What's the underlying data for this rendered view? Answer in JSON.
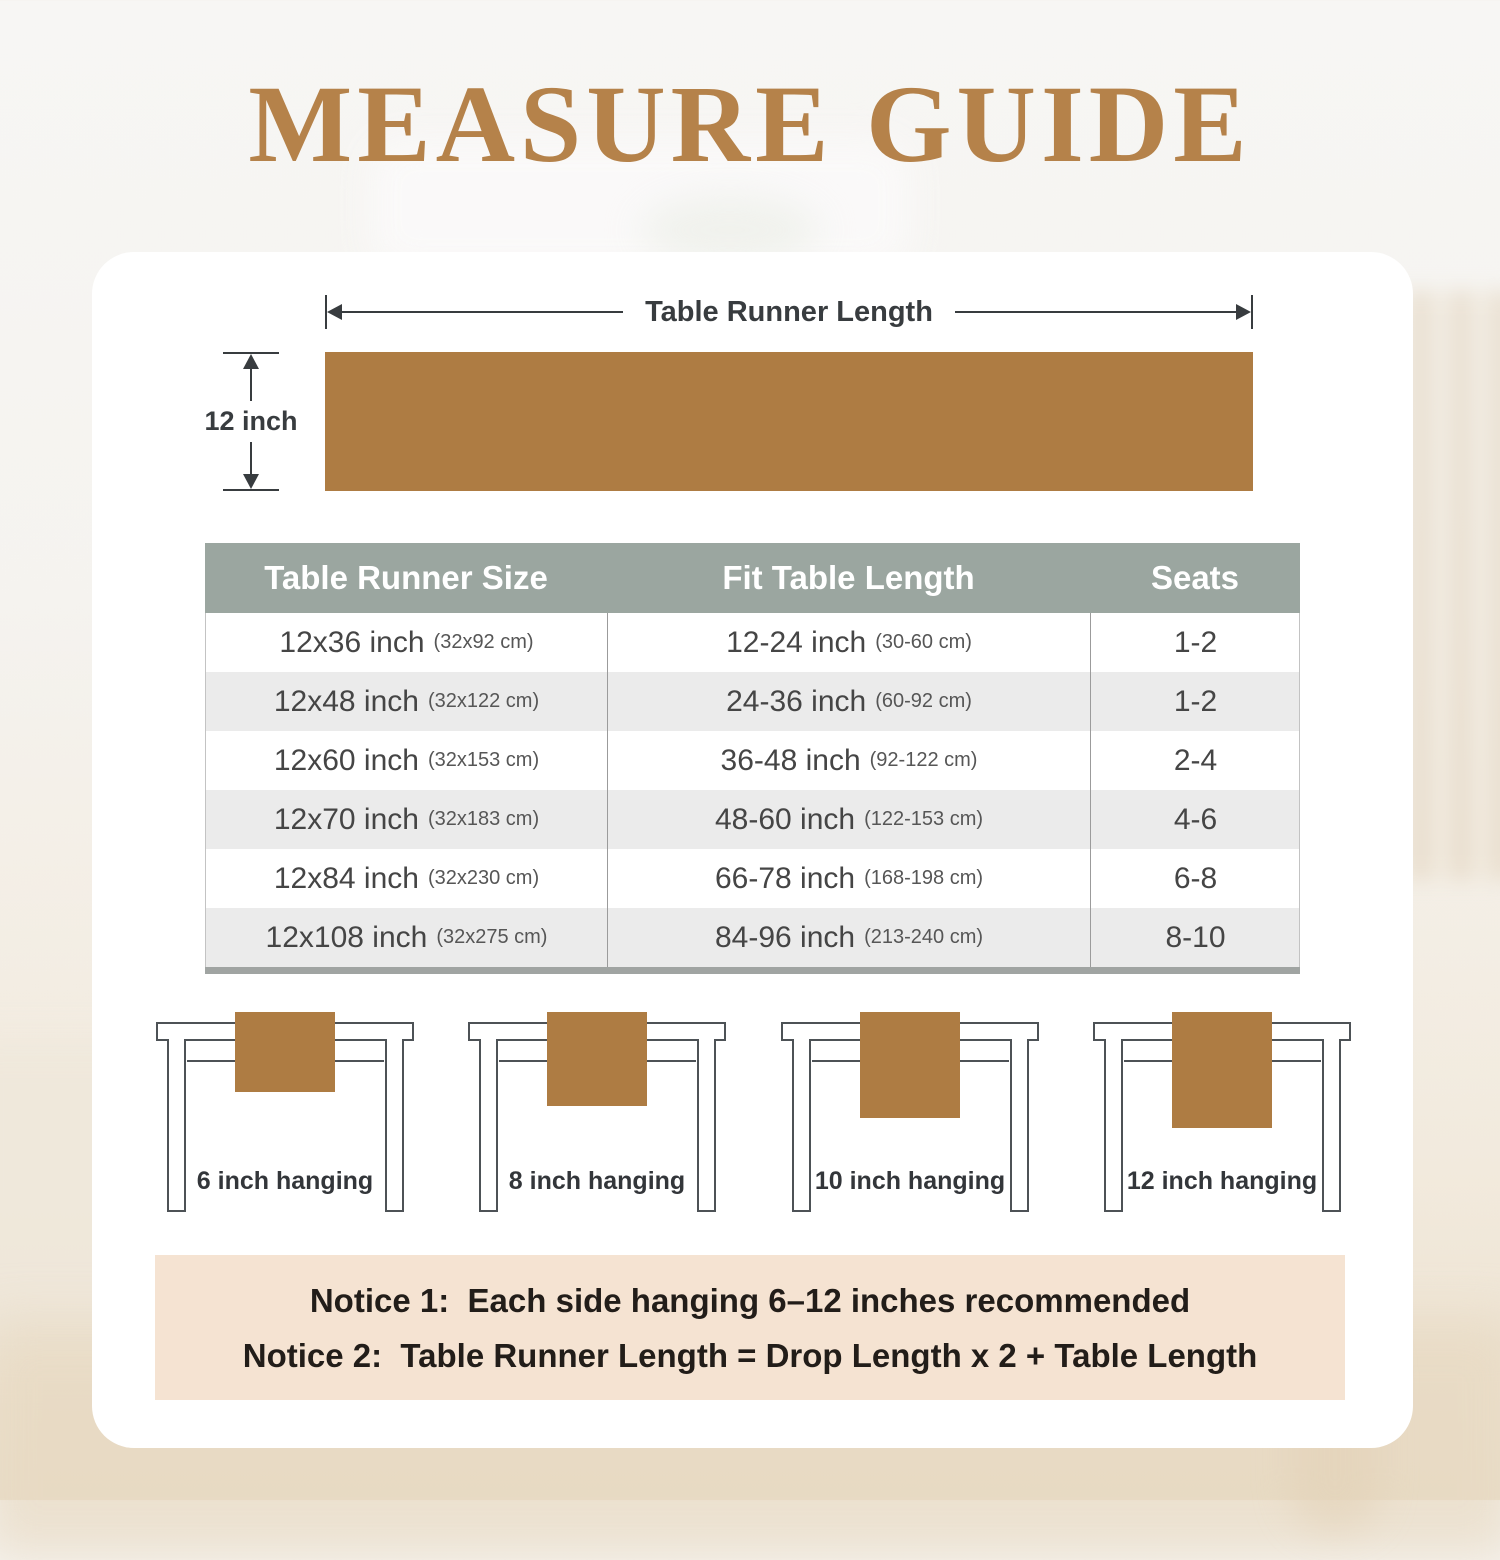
{
  "title": "MEASURE GUIDE",
  "diagram": {
    "length_label": "Table Runner Length",
    "width_label": "12 inch"
  },
  "table": {
    "headers": [
      "Table Runner Size",
      "Fit Table Length",
      "Seats"
    ],
    "rows": [
      {
        "size": "12x36 inch",
        "size_cm": "(32x92 cm)",
        "fit": "12-24 inch",
        "fit_cm": "(30-60 cm)",
        "seats": "1-2"
      },
      {
        "size": "12x48 inch",
        "size_cm": "(32x122 cm)",
        "fit": "24-36 inch",
        "fit_cm": "(60-92 cm)",
        "seats": "1-2"
      },
      {
        "size": "12x60 inch",
        "size_cm": "(32x153 cm)",
        "fit": "36-48 inch",
        "fit_cm": "(92-122 cm)",
        "seats": "2-4"
      },
      {
        "size": "12x70 inch",
        "size_cm": "(32x183 cm)",
        "fit": "48-60 inch",
        "fit_cm": "(122-153 cm)",
        "seats": "4-6"
      },
      {
        "size": "12x84 inch",
        "size_cm": "(32x230 cm)",
        "fit": "66-78 inch",
        "fit_cm": "(168-198 cm)",
        "seats": "6-8"
      },
      {
        "size": "12x108 inch",
        "size_cm": "(32x275 cm)",
        "fit": "84-96 inch",
        "fit_cm": "(213-240 cm)",
        "seats": "8-10"
      }
    ]
  },
  "hanging_examples": [
    {
      "label": "6 inch hanging"
    },
    {
      "label": "8 inch hanging"
    },
    {
      "label": "10 inch hanging"
    },
    {
      "label": "12 inch hanging"
    }
  ],
  "notices": {
    "line1": "Notice 1:  Each side hanging 6–12 inches recommended",
    "line2": "Notice 2:  Table Runner Length = Drop Length x 2 + Table Length"
  },
  "colors": {
    "title_brown": "#b5824a",
    "runner_brown": "#ae7c43",
    "header_gray_green": "#9ba6a0",
    "row_alt_gray": "#ebebeb",
    "notice_beige": "#f5e3d2"
  }
}
